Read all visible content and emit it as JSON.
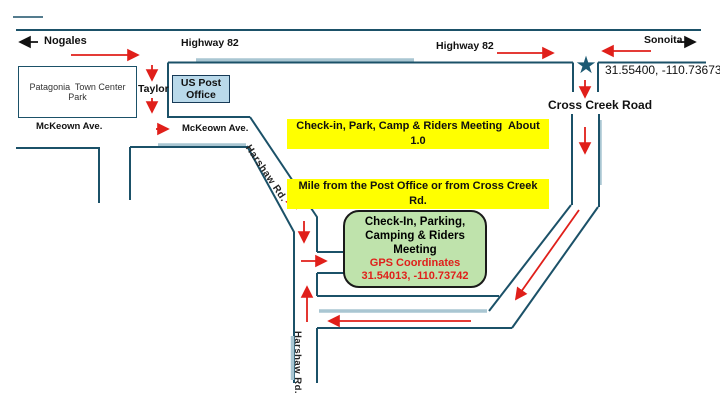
{
  "map": {
    "destinations": {
      "west": "Nogales",
      "east": "Sonoita"
    },
    "highway": {
      "label_left": "Highway 82",
      "label_right": "Highway 82"
    },
    "streets": {
      "taylor": "Taylor",
      "mckeown_left": "McKeown Ave.",
      "mckeown_right": "McKeown Ave.",
      "harshaw_diagonal": "Harshaw Rd.",
      "harshaw_vertical": "Harshaw Rd.",
      "cross_creek": "Cross Creek Road"
    },
    "park": {
      "line1": "Patagonia  Town Center",
      "line2": "Park"
    },
    "post_office": {
      "line1": "US Post",
      "line2": "Office"
    },
    "note": {
      "line1": "Check-in, Park, Camp & Riders Meeting  About 1.0",
      "line2": "Mile from the Post Office or from Cross Creek Rd.",
      "line3": "Turn Off"
    },
    "junction": {
      "gps": "31.55400, -110.73673",
      "star_icon": "★"
    },
    "checkin": {
      "line1": "Check-In, Parking,",
      "line2": "Camping & Riders",
      "line3": "Meeting",
      "gps_title": "GPS Coordinates",
      "gps_value": "31.54013, -110.73742"
    }
  },
  "colors": {
    "road": "#1b5168",
    "road_highlight_strip": "#a9c6d2",
    "route_arrow_red": "#e01f1a",
    "note_highlight_yellow": "#ffff00",
    "checkin_fill_green": "#bfe3ac",
    "post_office_fill_blue": "#b9d9ea",
    "star_teal": "#1d5a73",
    "text": "#111111"
  }
}
